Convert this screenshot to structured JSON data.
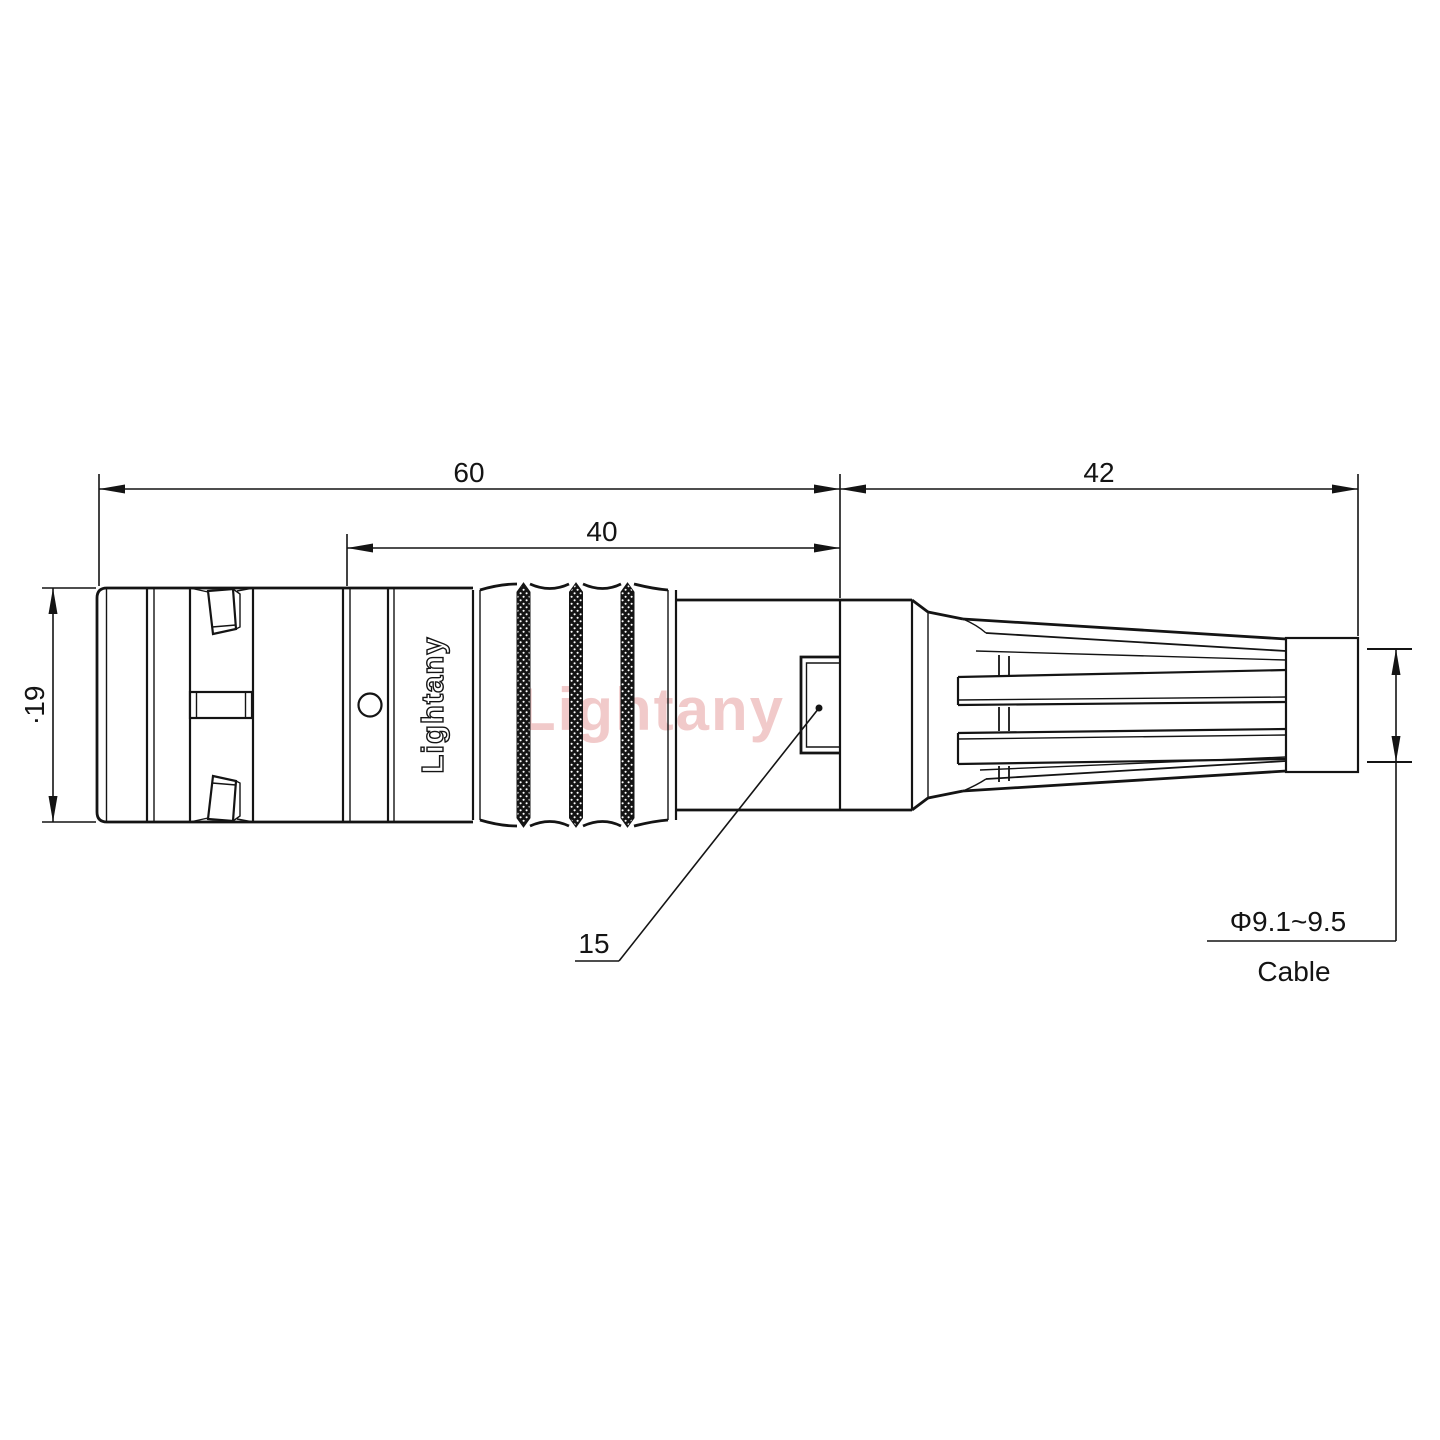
{
  "watermark_text": "Lightany",
  "body_marking": "Lightany",
  "dims": {
    "total_length": "60",
    "front_section_length": "40",
    "boot_length": "42",
    "front_diameter": "∙19",
    "pad_length": "15",
    "cable_diameter_range": "Φ9.1~9.5",
    "cable_label": "Cable"
  },
  "colors": {
    "line": "#141414",
    "watermark": "#dd7777",
    "background": "#ffffff"
  }
}
